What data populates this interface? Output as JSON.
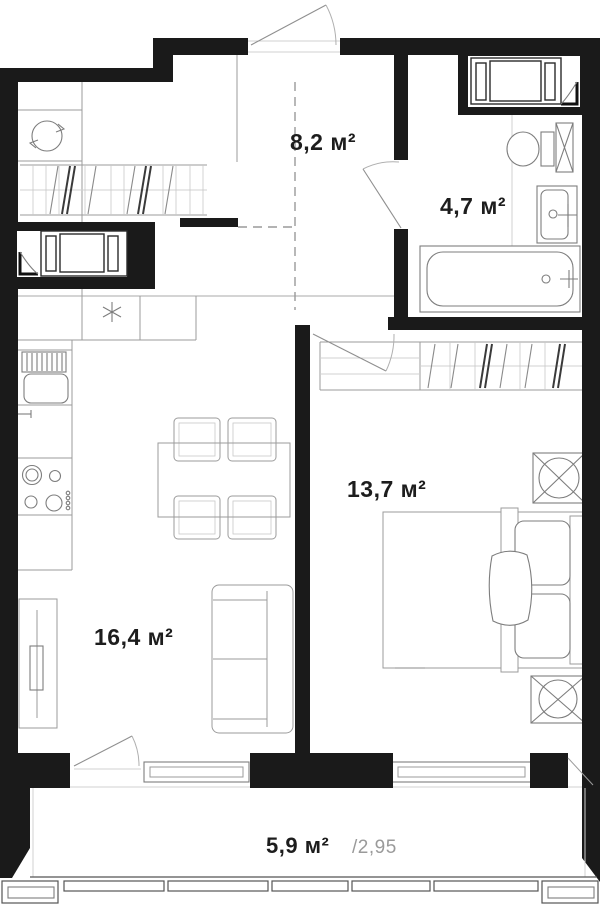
{
  "colors": {
    "wall": "#1a1a1a",
    "line": "#9b9b9b",
    "line-light": "#d0d0d0",
    "fixture": "#7d7d7d",
    "label": "#1d1d1d",
    "label-muted": "#9a9a9a",
    "bg": "#ffffff"
  },
  "rooms": {
    "hallway": {
      "area_label": "8,2 м²"
    },
    "bathroom": {
      "area_label": "4,7 м²"
    },
    "bedroom": {
      "area_label": "13,7 м²"
    },
    "living_kitchen": {
      "area_label": "16,4 м²"
    },
    "balcony": {
      "area_label": "5,9 м²",
      "reduced_area_label": "/2,95"
    }
  }
}
